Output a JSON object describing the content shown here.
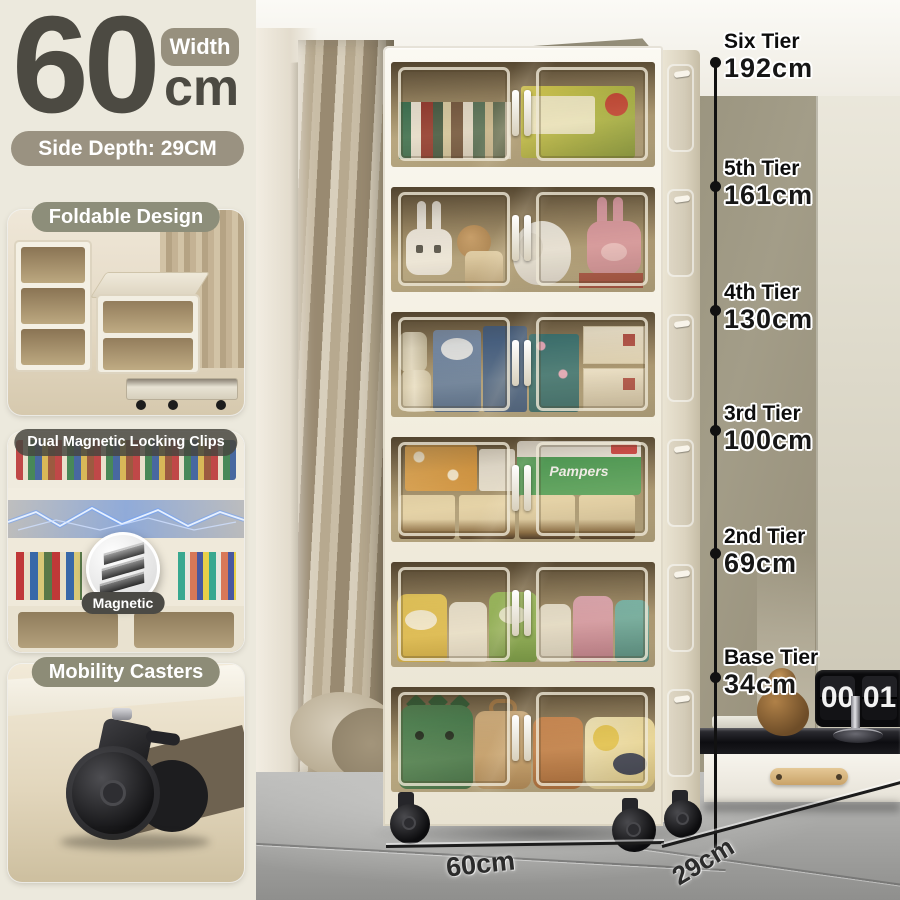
{
  "product_panel": {
    "width_value": "60",
    "width_unit": "cm",
    "width_badge": "Width",
    "side_depth_label": "Side Depth: 29CM",
    "features": [
      {
        "label": "Foldable Design"
      },
      {
        "label": "Dual Magnetic Locking Clips",
        "inset_label": "Magnetic"
      },
      {
        "label": "Mobility Casters"
      }
    ]
  },
  "tier_labels": [
    {
      "name": "Six Tier",
      "height": "192cm"
    },
    {
      "name": "5th Tier",
      "height": "161cm"
    },
    {
      "name": "4th Tier",
      "height": "130cm"
    },
    {
      "name": "3rd Tier",
      "height": "100cm"
    },
    {
      "name": "2nd Tier",
      "height": "69cm"
    },
    {
      "name": "Base Tier",
      "height": "34cm"
    }
  ],
  "floor_dimensions": {
    "width": "60cm",
    "depth": "29cm"
  },
  "scene": {
    "flip_clock": {
      "left_digits": "00",
      "right_digits": "01"
    },
    "pampers_label": "Pampers"
  },
  "colors": {
    "panel_background": "#ECE9DD",
    "badge_tan": "#97907E",
    "pill_olive": "#8D8E7A",
    "pill_dark": "#4B4A45",
    "headline_text": "#4C4A42",
    "cabinet_white": "#F4F0E6",
    "door_amber": "#A8916A"
  }
}
